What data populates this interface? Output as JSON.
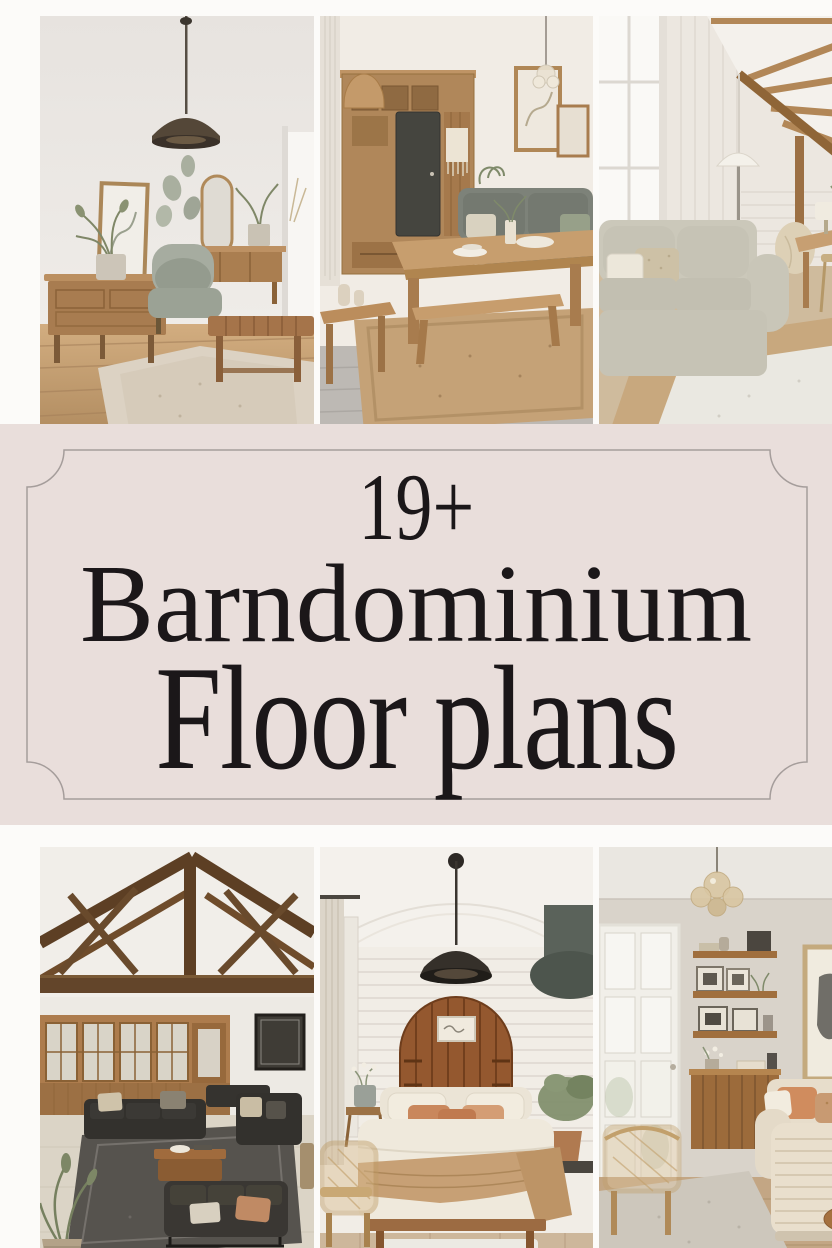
{
  "banner": {
    "count_text": "19+",
    "title_line_1": "Barndominium",
    "title_line_2": "Floor plans",
    "background_color": "#e9dedb",
    "text_color": "#1b1719",
    "frame_line_color": "#a59d9b"
  },
  "collage": {
    "gutter_color": "#fcfbf9",
    "photos": [
      {
        "id": "top-left",
        "subject": "neutral-living-room-credenza-armchair-pendant"
      },
      {
        "id": "top-middle",
        "subject": "farmhouse-dining-table-bench-wood-cabinet"
      },
      {
        "id": "top-right",
        "subject": "attic-lounge-wood-beam-ceiling-beige-sofa"
      },
      {
        "id": "bottom-left",
        "subject": "vaulted-timber-truss-great-room-black-sofas"
      },
      {
        "id": "bottom-middle",
        "subject": "bedroom-arched-wood-headboard-shiplap"
      },
      {
        "id": "bottom-right",
        "subject": "living-room-floating-shelves-cream-sofa"
      }
    ]
  }
}
